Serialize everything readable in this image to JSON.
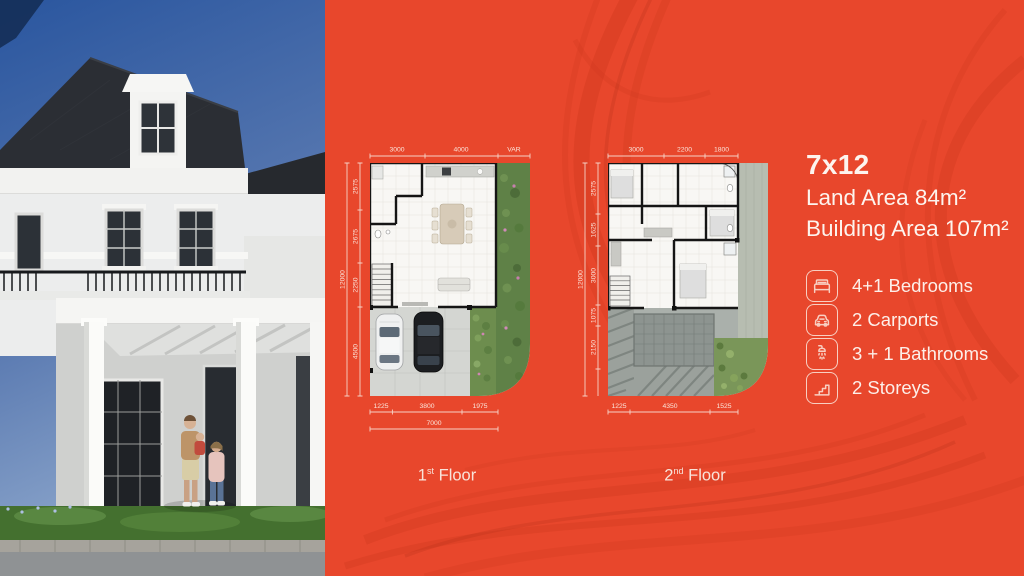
{
  "colors": {
    "background_orange": "#e8472c",
    "texture_red": "#cf3a1f",
    "dimension_line": "#f6d2c6",
    "text_light": "#fdf4ee",
    "garden_green": "#5f8147",
    "wall_black": "#151515",
    "sky_blue": "#2a569f",
    "roof_dark": "#2b2e34"
  },
  "header": {
    "model": "7x12",
    "land_area": "Land Area 84m²",
    "building_area": "Building Area 107m²"
  },
  "features": [
    {
      "icon": "bed-icon",
      "label": "4+1 Bedrooms"
    },
    {
      "icon": "car-icon",
      "label": "2 Carports"
    },
    {
      "icon": "shower-icon",
      "label": "3 + 1 Bathrooms"
    },
    {
      "icon": "stairs-icon",
      "label": "2 Storeys"
    }
  ],
  "plans": [
    {
      "name": "first-floor-plan",
      "label": {
        "num": "1",
        "sup": "st",
        "rest": " Floor"
      },
      "dims_top": [
        "3000",
        "4000",
        "VAR"
      ],
      "dims_left": [
        "2575",
        "2675",
        "2250",
        "4500"
      ],
      "dims_left_total": "12000",
      "dims_bottom": [
        "1225",
        "3800",
        "1975"
      ],
      "dims_bottom_total": "7000"
    },
    {
      "name": "second-floor-plan",
      "label": {
        "num": "2",
        "sup": "nd",
        "rest": " Floor"
      },
      "dims_top": [
        "3000",
        "2200",
        "1800"
      ],
      "dims_left": [
        "2575",
        "1625",
        "3000",
        "1075",
        "2150"
      ],
      "dims_left_total": "12000",
      "dims_bottom": [
        "1225",
        "4350",
        "1525"
      ]
    }
  ]
}
